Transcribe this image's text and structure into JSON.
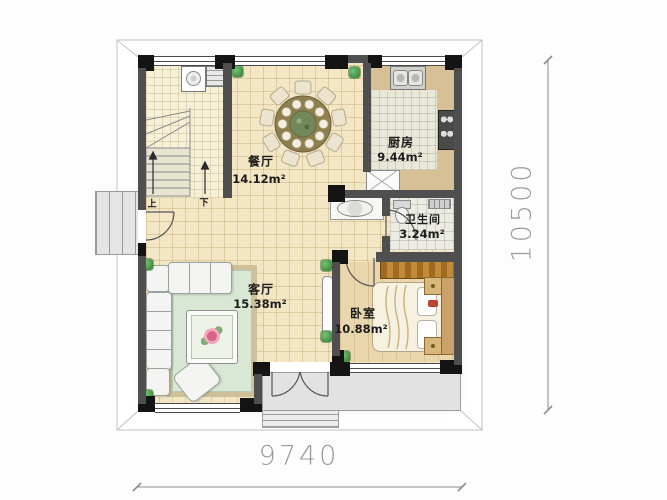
{
  "plan": {
    "rooms": [
      {
        "name": "餐厅",
        "area": "14.12m²"
      },
      {
        "name": "厨房",
        "area": "9.44m²"
      },
      {
        "name": "卫生间",
        "area": "3.24m²"
      },
      {
        "name": "客厅",
        "area": "15.38m²"
      },
      {
        "name": "卧室",
        "area": "10.88m²"
      }
    ],
    "stairs": {
      "up_label": "上",
      "down_label": "下"
    },
    "dimensions": {
      "width_mm": "9740",
      "height_mm": "10500"
    },
    "colors": {
      "wall": "#4f4f4f",
      "pier": "#141414",
      "floor_tile": "#f3e6c4",
      "rug": "#d8e8d4",
      "wardrobe": "#b07b2e",
      "kitchen_counter": "#d8c096",
      "dimension_text": "#9a9a9a",
      "plant": "#2f7d2f"
    }
  }
}
